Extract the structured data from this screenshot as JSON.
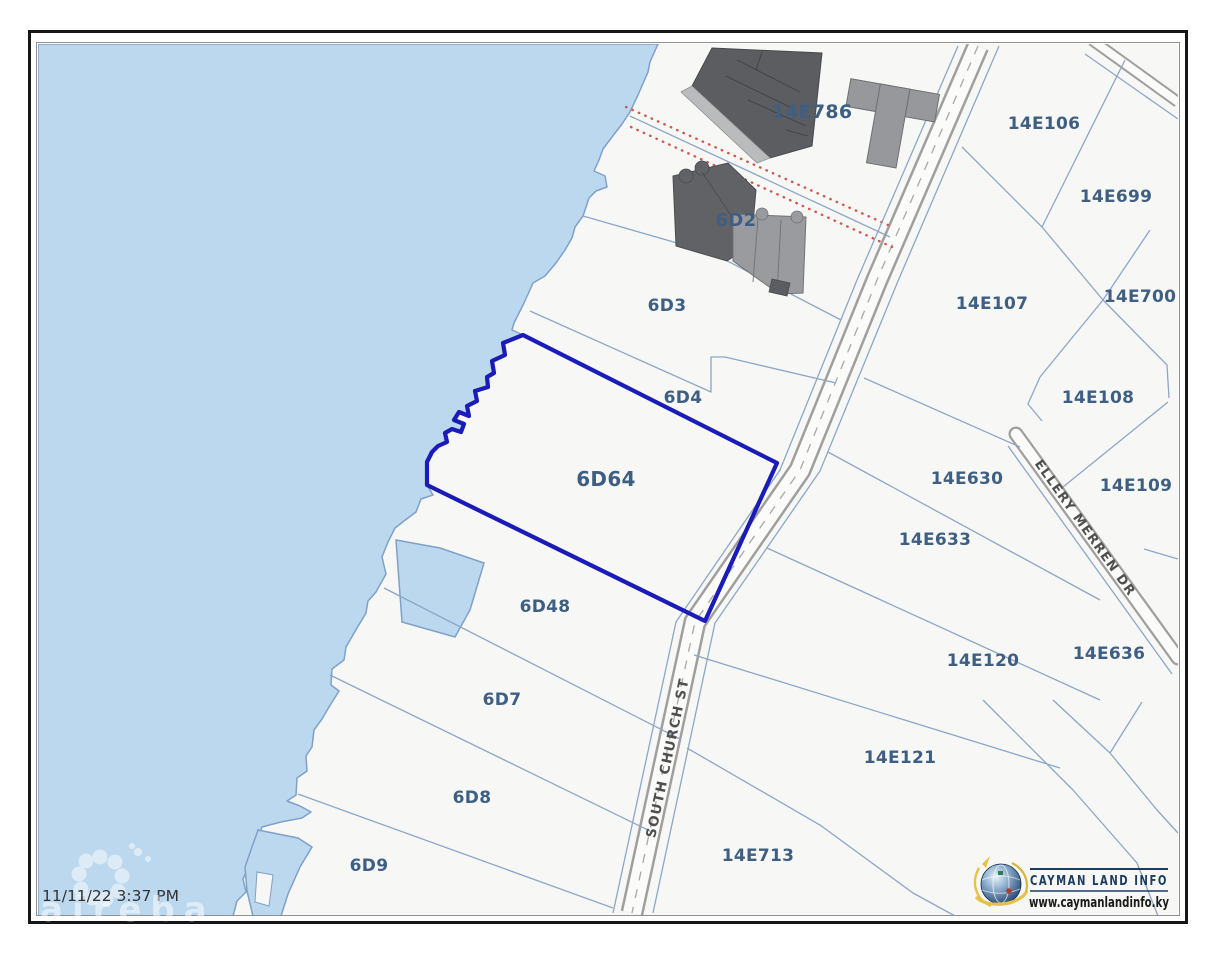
{
  "map": {
    "timestamp": "11/11/22 3:37 PM",
    "watermark_text": "aireba",
    "highlighted_parcel": "6D64",
    "parcels": [
      {
        "label": "14E786"
      },
      {
        "label": "6D2"
      },
      {
        "label": "6D3"
      },
      {
        "label": "6D4"
      },
      {
        "label": "6D64"
      },
      {
        "label": "6D48"
      },
      {
        "label": "6D7"
      },
      {
        "label": "6D8"
      },
      {
        "label": "6D9"
      },
      {
        "label": "14E713"
      },
      {
        "label": "14E106"
      },
      {
        "label": "14E699"
      },
      {
        "label": "14E107"
      },
      {
        "label": "14E700"
      },
      {
        "label": "14E108"
      },
      {
        "label": "14E630"
      },
      {
        "label": "14E109"
      },
      {
        "label": "14E633"
      },
      {
        "label": "14E120"
      },
      {
        "label": "14E636"
      },
      {
        "label": "14E121"
      }
    ],
    "streets": [
      {
        "name": "SOUTH CHURCH ST"
      },
      {
        "name": "ELLERY MERREN DR"
      }
    ]
  },
  "branding": {
    "name": "CAYMAN LAND INFO",
    "website": "www.caymanlandinfo.ky"
  },
  "colors": {
    "water": "#bcd8ee",
    "land": "#f7f8f6",
    "parcel_line": "#8ca6c6",
    "road_edge": "#9f9f9d",
    "highlight": "#1b1bb8",
    "red_boundary": "#d05a50",
    "label": "#3e5f82",
    "building_dark": "#5b5d60",
    "building_light": "#98999b",
    "frame": "#161616"
  }
}
